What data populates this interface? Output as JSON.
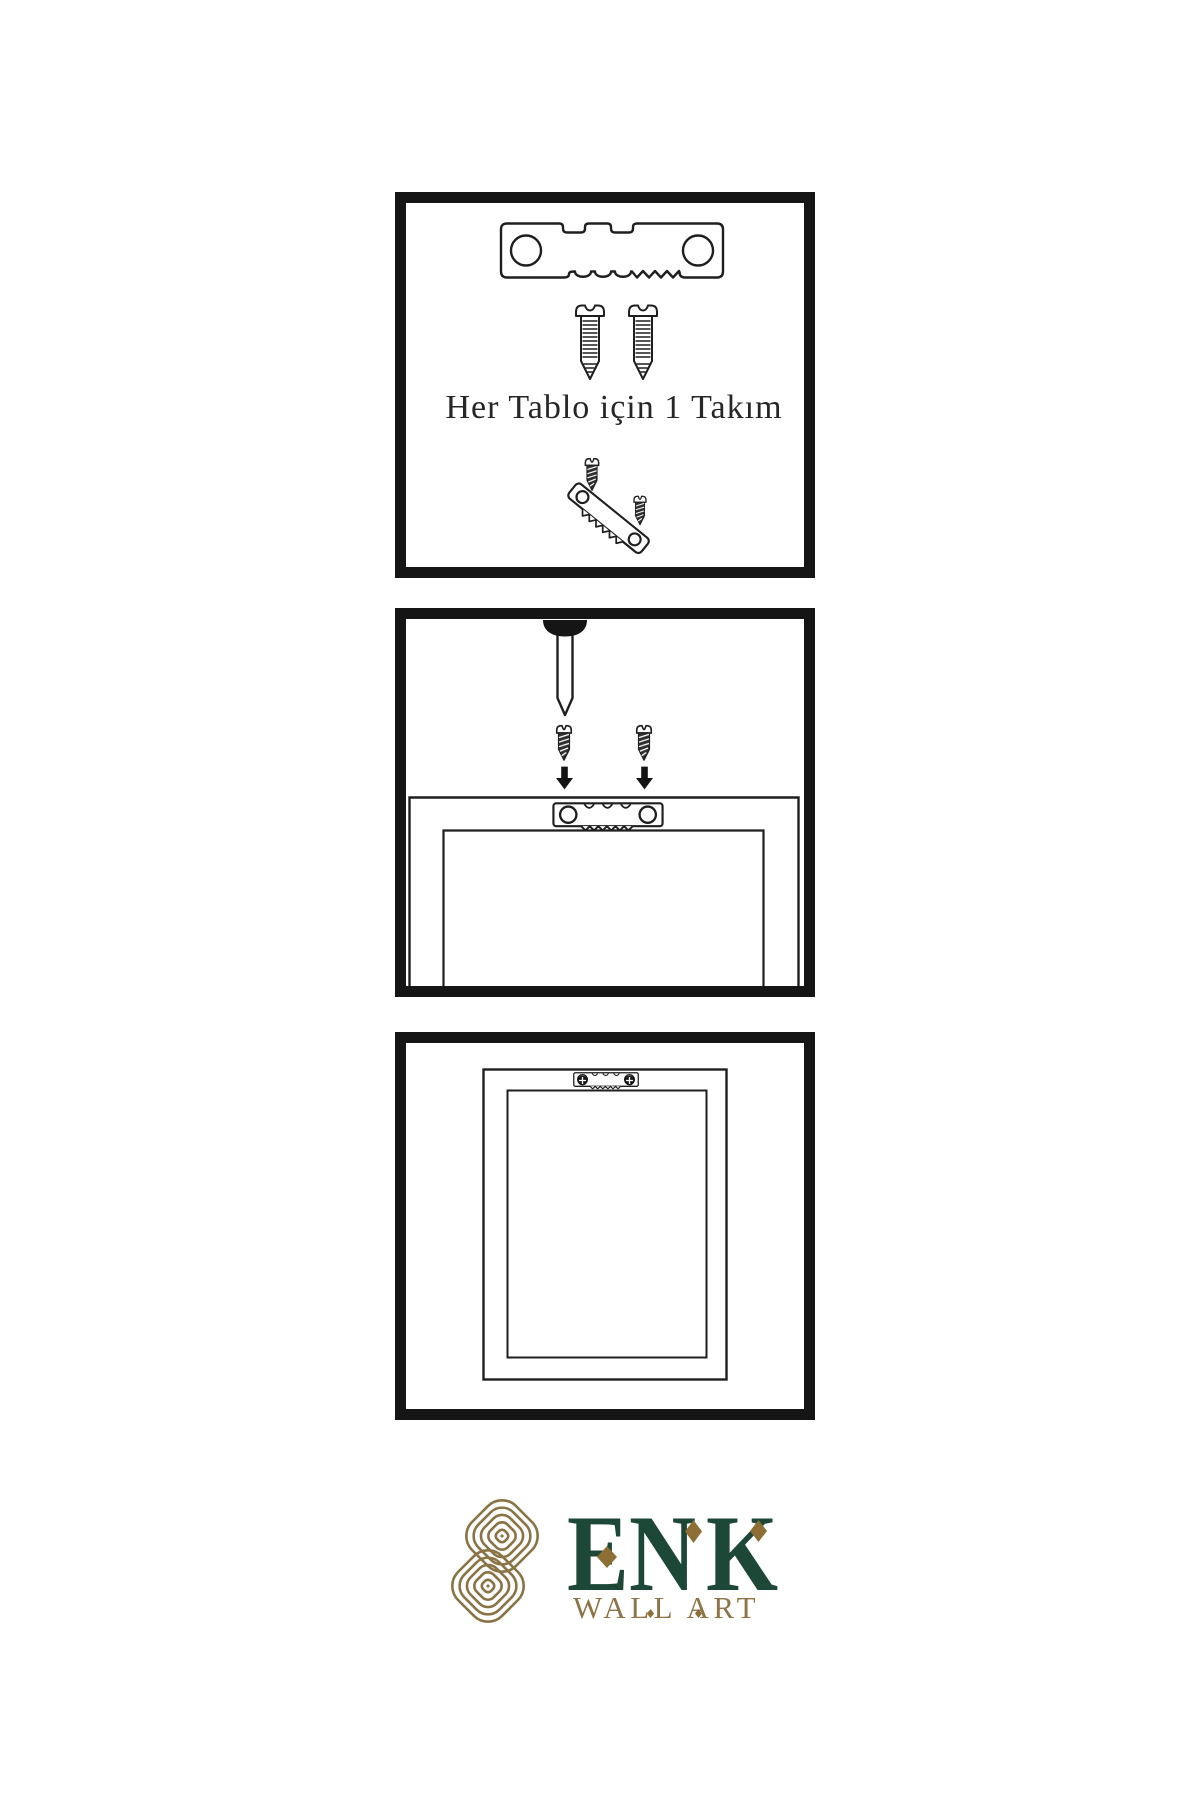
{
  "colors": {
    "background": "#ffffff",
    "line": "#1f1f1f",
    "panel_border": "#151515",
    "logo_green": "#1d4737",
    "logo_gold": "#8a7445",
    "diamond_gold": "#8d6f35"
  },
  "instructions": {
    "panel1": {
      "name": "hardware-kit",
      "caption": "Her Tablo için 1 Takım",
      "items": [
        "sawtooth-hanger",
        "screw",
        "screw",
        "screw-driven-into-hanger"
      ]
    },
    "panel2": {
      "name": "mount-hanger-on-frame-back",
      "items": [
        "wall-nail",
        "screw",
        "screw",
        "down-arrow",
        "down-arrow",
        "sawtooth-hanger-plate",
        "frame-back"
      ]
    },
    "panel3": {
      "name": "frame-back-with-mounted-hanger",
      "items": [
        "frame-back",
        "sawtooth-hanger-plate",
        "phillips-screw-head",
        "phillips-screw-head"
      ]
    }
  },
  "logo": {
    "brand": "ENK",
    "letters": [
      "E",
      "N",
      "K"
    ],
    "subtitle": "WALL ART"
  },
  "icons": {
    "sawtooth-hanger-icon": "metal strip with two holes and sawtooth edge",
    "screw-side-icon": "slotted screw, side view, threaded",
    "dark-screw-icon": "short dark screw, side view",
    "wall-nail-icon": "nail hanging from wall, point down",
    "down-arrow-icon": "▼",
    "phillips-screw-head-icon": "⊕",
    "knot-logo-icon": "interlaced double-loop knot emblem",
    "diamond-accent-icon": "◆"
  }
}
